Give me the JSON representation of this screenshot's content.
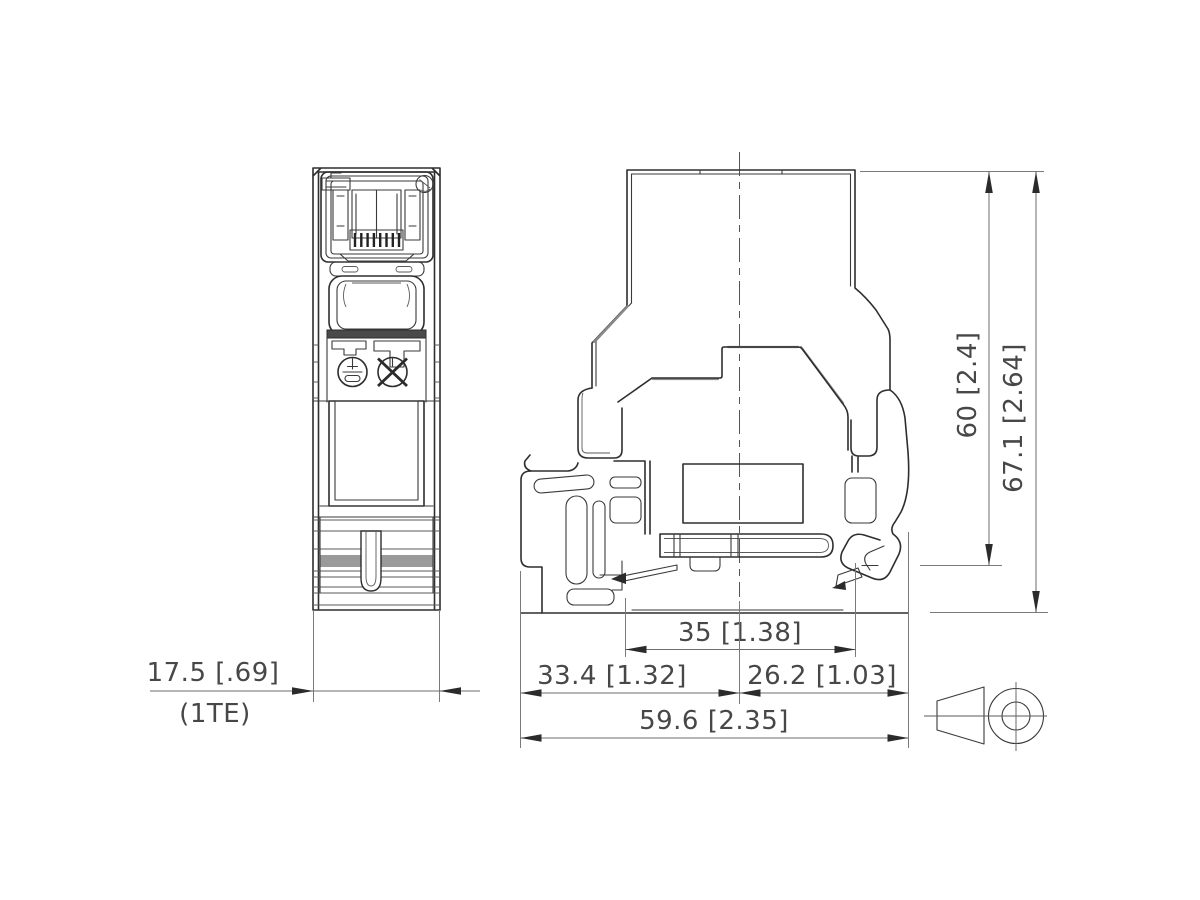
{
  "drawing": {
    "dimensions": {
      "front_width": "17.5 [.69]",
      "front_width_note": "(1TE)",
      "rail_width": "35 [1.38]",
      "left_span": "33.4 [1.32]",
      "right_span": "26.2 [1.03]",
      "total_width": "59.6 [2.35]",
      "rail_height": "60 [2.4]",
      "total_height": "67.1 [2.64]"
    },
    "icons": {
      "projection_symbol": "first-angle-projection-symbol",
      "earth_symbol": "earth-contact-symbol",
      "no_contact_symbol": "crossed-circle-symbol"
    },
    "colors": {
      "background": "#ffffff",
      "line_dark": "#2e2e2e",
      "line_gray": "#8c8c8c",
      "dimension_line": "#6e6e6e",
      "text": "#474747",
      "stripe_band_fill": "#9a9a9a",
      "retainer_bar_fill": "#4a4a4a"
    }
  }
}
